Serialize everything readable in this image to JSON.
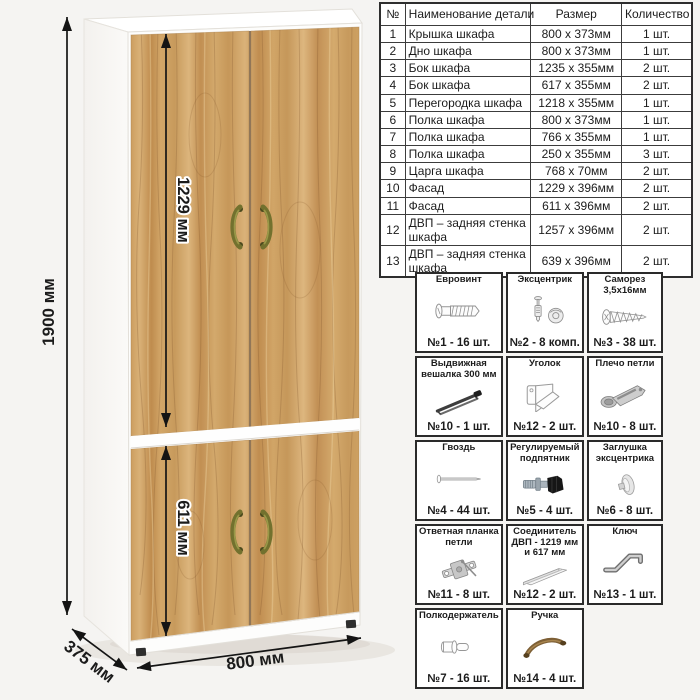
{
  "dimensions": {
    "height": "1900 мм",
    "width": "800 мм",
    "depth": "375 мм",
    "top_facade": "1229 мм",
    "bottom_facade": "611 мм"
  },
  "colors": {
    "wood": "#c89a5e",
    "carcass": "#ffffff",
    "handle": "#6f6e2c",
    "dimension_lines": "#141414"
  },
  "parts_table": {
    "headers": [
      "№",
      "Наименование детали",
      "Размер",
      "Количество"
    ],
    "rows": [
      [
        "1",
        "Крышка шкафа",
        "800 х 373мм",
        "1 шт."
      ],
      [
        "2",
        "Дно шкафа",
        "800 х 373мм",
        "1 шт."
      ],
      [
        "3",
        "Бок шкафа",
        "1235 х 355мм",
        "2 шт."
      ],
      [
        "4",
        "Бок шкафа",
        "617 х 355мм",
        "2 шт."
      ],
      [
        "5",
        "Перегородка шкафа",
        "1218 х 355мм",
        "1 шт."
      ],
      [
        "6",
        "Полка шкафа",
        "800 х 373мм",
        "1 шт."
      ],
      [
        "7",
        "Полка шкафа",
        "766 х 355мм",
        "1 шт."
      ],
      [
        "8",
        "Полка шкафа",
        "250 х 355мм",
        "3 шт."
      ],
      [
        "9",
        "Царга шкафа",
        "768 х 70мм",
        "2 шт."
      ],
      [
        "10",
        "Фасад",
        "1229 х 396мм",
        "2 шт."
      ],
      [
        "11",
        "Фасад",
        "611 х 396мм",
        "2 шт."
      ],
      [
        "12",
        "ДВП – задняя стенка шкафа",
        "1257 х 396мм",
        "2 шт."
      ],
      [
        "13",
        "ДВП – задняя стенка шкафа",
        "639 х 396мм",
        "2 шт."
      ]
    ]
  },
  "hardware": {
    "items": [
      {
        "title": "Евровинт",
        "icon": "confirmat-screw-icon",
        "count": "№1 - 16 шт."
      },
      {
        "title": "Эксцентрик",
        "icon": "cam-lock-icon",
        "count": "№2 - 8 комп."
      },
      {
        "title": "Саморез 3,5х16мм",
        "icon": "self-tapping-screw-icon",
        "count": "№3 - 38 шт."
      },
      {
        "title": "Выдвижная вешалка 300 мм",
        "icon": "pull-out-hanger-icon",
        "count": "№10 - 1 шт."
      },
      {
        "title": "Уголок",
        "icon": "corner-bracket-icon",
        "count": "№12 - 2 шт."
      },
      {
        "title": "Плечо петли",
        "icon": "hinge-arm-icon",
        "count": "№10 - 8 шт."
      },
      {
        "title": "Гвоздь",
        "icon": "nail-icon",
        "count": "№4 - 44 шт."
      },
      {
        "title": "Регулируемый подпятник",
        "icon": "adjustable-foot-icon",
        "count": "№5 - 4 шт."
      },
      {
        "title": "Заглушка эксцентрика",
        "icon": "cam-cover-icon",
        "count": "№6 - 8 шт."
      },
      {
        "title": "Ответная планка петли",
        "icon": "hinge-mounting-plate-icon",
        "count": "№11 - 8 шт."
      },
      {
        "title": "Соединитель ДВП - 1219 мм и 617 мм",
        "icon": "hdf-connector-icon",
        "count": "№12 - 2 шт."
      },
      {
        "title": "Ключ",
        "icon": "hex-key-icon",
        "count": "№13 - 1 шт."
      },
      {
        "title": "Полкодержатель",
        "icon": "shelf-pin-icon",
        "count": "№7 - 16 шт."
      },
      {
        "title": "Ручка",
        "icon": "handle-icon",
        "count": "№14 - 4 шт."
      }
    ]
  }
}
